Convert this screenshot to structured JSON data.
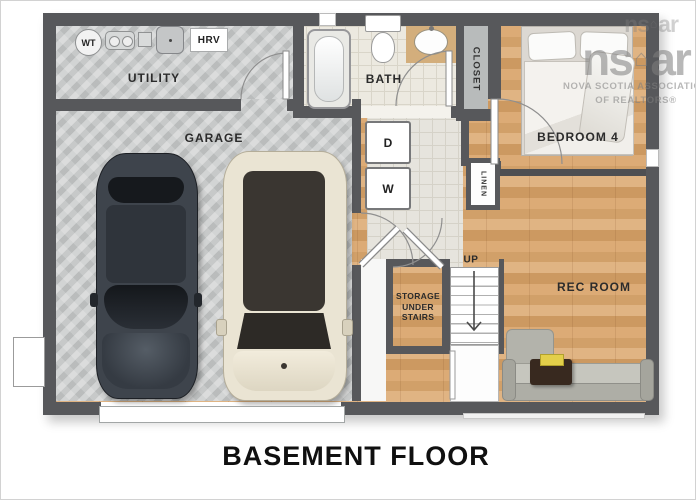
{
  "title": "BASEMENT FLOOR",
  "rooms": {
    "utility": "UTILITY",
    "garage": "GARAGE",
    "bath": "BATH",
    "closet": "CLOSET",
    "bedroom4": "BEDROOM 4",
    "rec_room": "REC ROOM",
    "linen": "LINEN",
    "storage": "STORAGE UNDER STAIRS",
    "stairs_up": "UP"
  },
  "equipment": {
    "water_tank": "WT",
    "hrv": "HRV",
    "dryer": "D",
    "washer": "W"
  },
  "watermark": {
    "logo_left": "ns",
    "logo_house": "⌂",
    "logo_right": "ar",
    "line1": "NOVA SCOTIA ASSOCIATION",
    "line2": "OF REALTORS®"
  },
  "colors": {
    "wall": "#57585b",
    "wood_floor": "#d8a873",
    "concrete": "#c7c9c9",
    "tile": "#ece9e0",
    "sofa": "#b9b9b1",
    "table_book": "#e3cf4a"
  }
}
